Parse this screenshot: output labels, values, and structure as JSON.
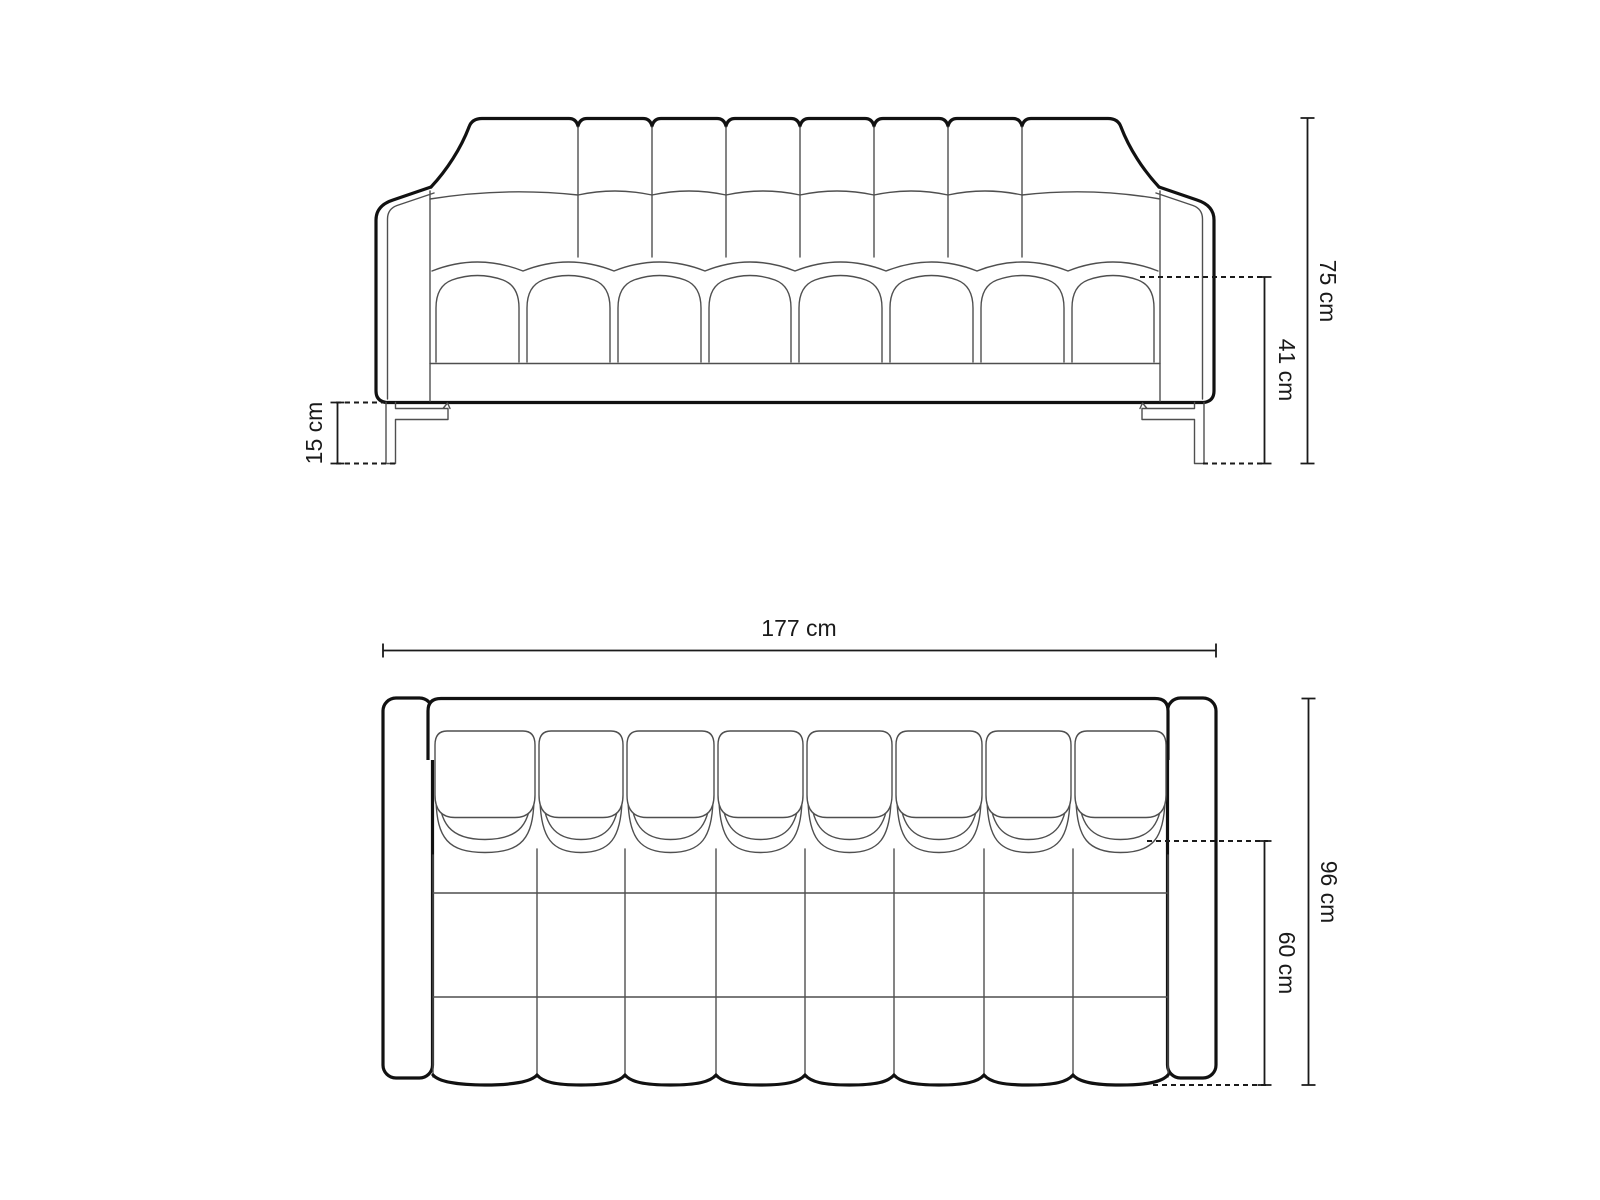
{
  "diagram": {
    "type": "sofa-dimension-drawing",
    "views": {
      "front": {
        "label_height": "75 cm",
        "label_seat_height": "41 cm",
        "label_leg_height": "15 cm"
      },
      "top": {
        "label_width": "177 cm",
        "label_depth": "96 cm",
        "label_seat_depth": "60 cm"
      }
    },
    "colors": {
      "outline": "#111111",
      "seam": "#4f4f4f",
      "dimension": "#1a1a1a",
      "background": "#ffffff"
    }
  }
}
